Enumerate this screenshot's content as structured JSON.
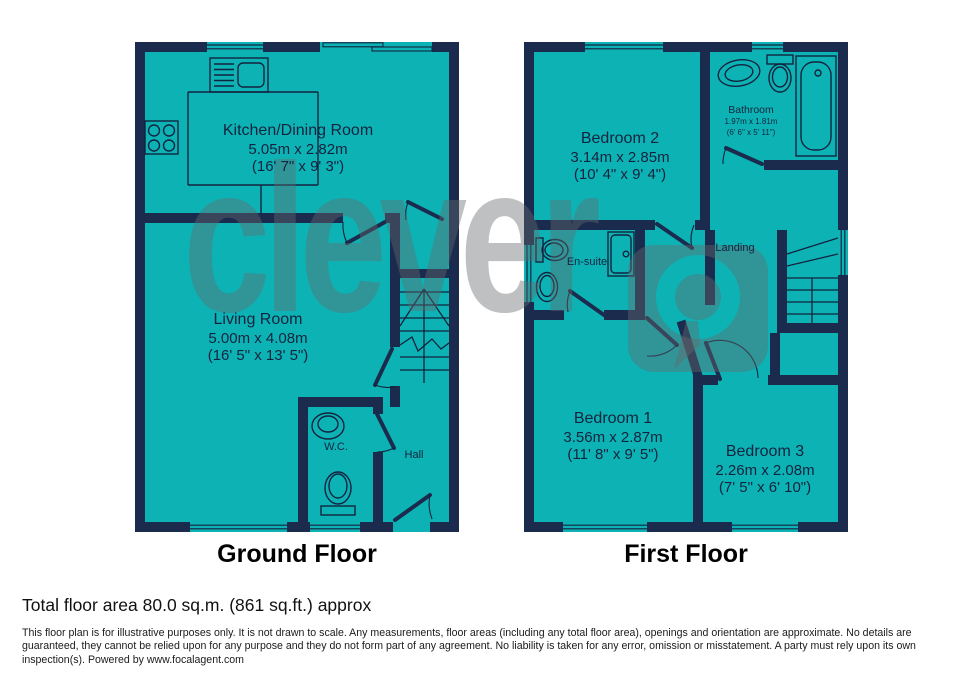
{
  "watermark": {
    "brand": "clever"
  },
  "floors": [
    {
      "title": "Ground Floor",
      "rooms": [
        {
          "name": "Kitchen/Dining Room",
          "metric": "5.05m x 2.82m",
          "imperial": "(16' 7\" x 9' 3\")"
        },
        {
          "name": "Living Room",
          "metric": "5.00m x 4.08m",
          "imperial": "(16' 5\" x 13' 5\")"
        },
        {
          "name": "W.C."
        },
        {
          "name": "Hall"
        }
      ]
    },
    {
      "title": "First Floor",
      "rooms": [
        {
          "name": "Bedroom 2",
          "metric": "3.14m x 2.85m",
          "imperial": "(10' 4\" x 9' 4\")"
        },
        {
          "name": "Bathroom",
          "metric": "1.97m x 1.81m",
          "imperial": "(6' 6\" x 5' 11\")"
        },
        {
          "name": "En-suite"
        },
        {
          "name": "Landing"
        },
        {
          "name": "Bedroom 1",
          "metric": "3.56m x 2.87m",
          "imperial": "(11' 8\" x 9' 5\")"
        },
        {
          "name": "Bedroom 3",
          "metric": "2.26m x 2.08m",
          "imperial": "(7' 5\" x 6' 10\")"
        }
      ]
    }
  ],
  "footer": {
    "total_area": "Total floor area 80.0 sq.m. (861 sq.ft.) approx",
    "disclaimer": "This floor plan is for illustrative purposes only. It is not drawn to scale. Any measurements, floor areas (including any total floor area), openings and orientation are approximate. No details are guaranteed, they cannot be relied upon for any purpose and they do not form part of any agreement. No liability is taken for any error, omission or misstatement. A party must rely upon its own inspection(s). Powered by www.focalagent.com"
  },
  "colors": {
    "room_fill": "#0db3b4",
    "wall": "#1a2b4d",
    "line": "#13233f",
    "watermark_gray": "rgba(100,106,110,0.42)"
  }
}
